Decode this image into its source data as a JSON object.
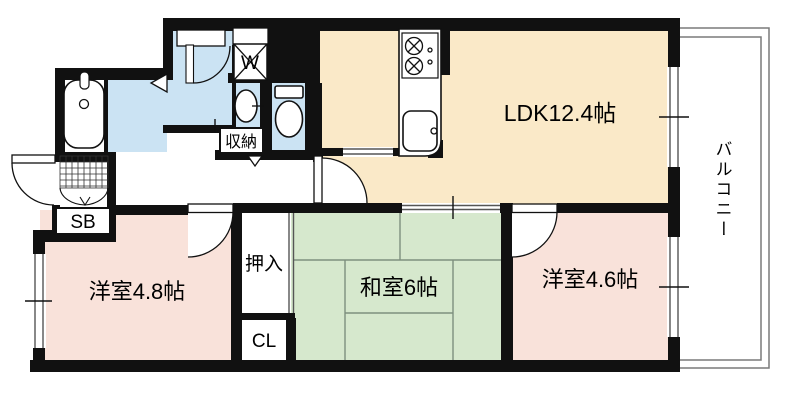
{
  "floorplan": {
    "rooms": {
      "ldk": {
        "label": "LDK12.4帖",
        "color": "#fae9c8"
      },
      "balcony": {
        "label": "バルコニー",
        "color": "#ffffff"
      },
      "western_room_1": {
        "label": "洋室4.8帖",
        "color": "#f9e2da"
      },
      "japanese_room": {
        "label": "和室6帖",
        "color": "#d6e8cd"
      },
      "western_room_2": {
        "label": "洋室4.6帖",
        "color": "#f9e2da"
      }
    },
    "labels": {
      "oshiire": "押入",
      "closet": "CL",
      "shoebox": "SB",
      "storage": "収納",
      "washer": "W"
    },
    "colors": {
      "wall": "#111111",
      "wet_area": "#cbe3f3",
      "tatami_line": "#7e907e",
      "balcony_line": "#7a7a7a"
    }
  }
}
